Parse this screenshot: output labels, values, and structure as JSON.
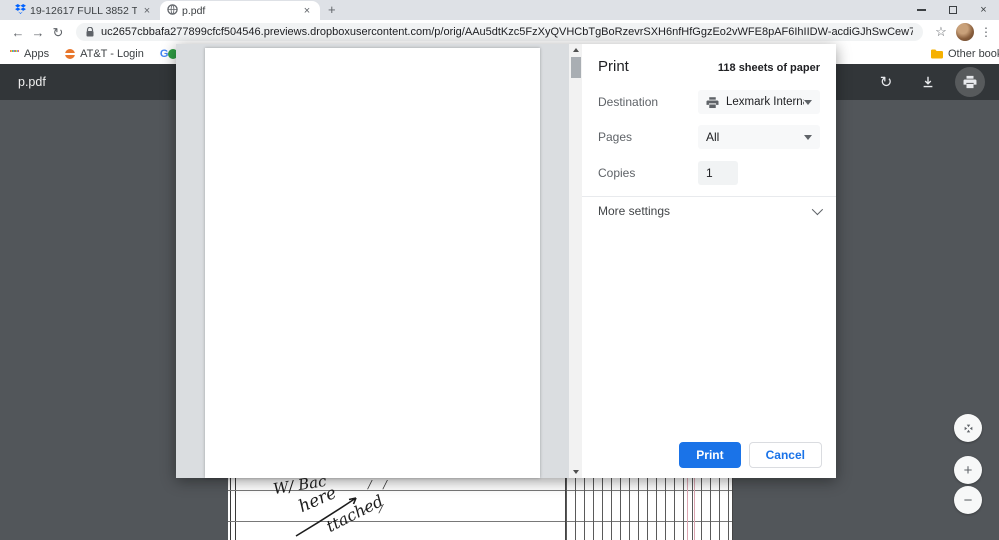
{
  "tab_strip": {
    "tabs": [
      {
        "title": "19-12617 FULL 3852 Tupelo Bran",
        "close": "×"
      },
      {
        "title": "p.pdf",
        "close": "×"
      }
    ],
    "new_tab": "+"
  },
  "window": {
    "close": "×"
  },
  "toolbar": {
    "back": "←",
    "forward": "→",
    "reload": "↻",
    "url": "uc2657cbbafa277899cfcf504546.previews.dropboxusercontent.com/p/orig/AAu5dtKzc5FzXyQVHCbTgBoRzevrSXH6nfHfGgzEo2vWFE8pAF6IhIIDW-acdiGJhSwCew7ZAUbitJRRlDMZsKG7nAR1pVfBkvBQV4_h7…",
    "bookmark_star": "☆",
    "menu": "⋮"
  },
  "bookmarks_bar": {
    "items": [
      {
        "label": "Apps"
      },
      {
        "label": "AT&T - Login"
      },
      {
        "label": "Gmail"
      }
    ],
    "other_bookmarks": "Other bookmark"
  },
  "pdf_viewer": {
    "title": "p.pdf",
    "rotate": "↻",
    "zoom_in": "+",
    "zoom_out": "−"
  },
  "print_dialog": {
    "title": "Print",
    "sheets": "118 sheets of paper",
    "destination_label": "Destination",
    "destination_value": "Lexmark International",
    "pages_label": "Pages",
    "pages_value": "All",
    "copies_label": "Copies",
    "copies_value": "1",
    "more_settings_label": "More settings",
    "print_button": "Print",
    "cancel_button": "Cancel"
  },
  "document_page": {
    "handwriting": [
      "W/ Bac",
      "here",
      "ttached"
    ],
    "tick_marks": "/ /"
  },
  "colors": {
    "accent_blue": "#1a73e8",
    "pdf_toolbar": "#323639",
    "pdf_background": "#52565a"
  }
}
